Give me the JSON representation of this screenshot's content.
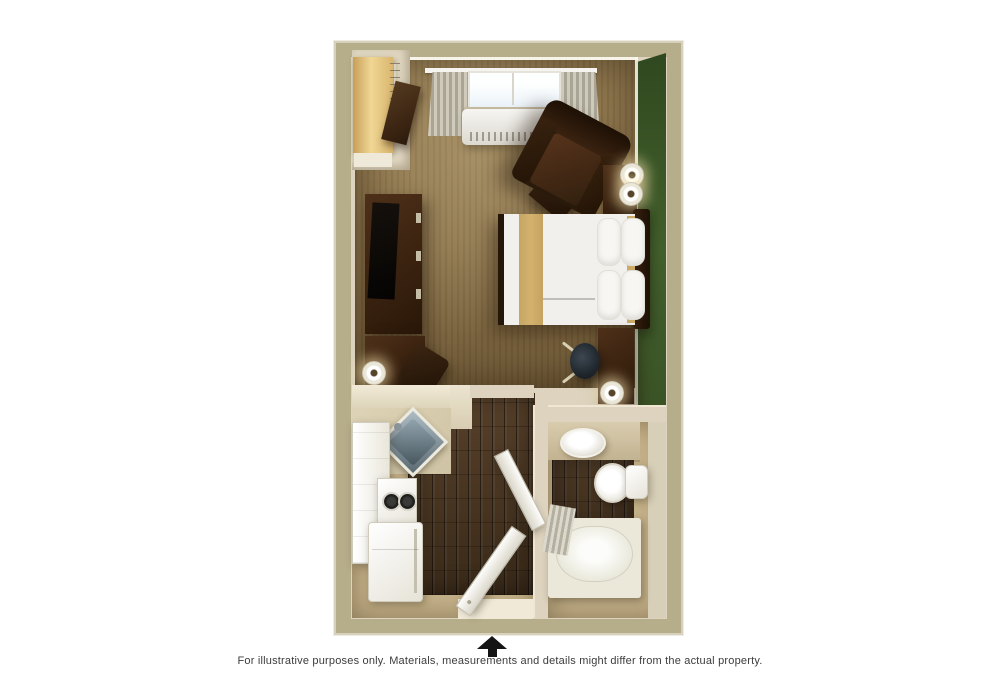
{
  "figure": {
    "type": "floor-plan",
    "description_visible_text_only": true
  },
  "caption": {
    "text": "For illustrative purposes only.  Materials, measurements and details might differ from the actual property."
  },
  "entrance": {
    "marker": "up-arrow"
  },
  "palette": {
    "outer_wall": "#b6ad8b",
    "wall_face": "#ddd3be",
    "carpet": "#8b734b",
    "wood_floor": "#4e3a26",
    "bath_floor": "#c4b189",
    "green_wall": "#42602c",
    "furniture_dark": "#2a1708",
    "bed_white": "#f1f0ed",
    "bed_accent_tan": "#d4b26e",
    "closet_wood": "#e9cf92",
    "appliance_white": "#f7f6f1",
    "curtain_gray": "#b5b1a2",
    "window_glass": "#e9f2f8",
    "arrow": "#141414",
    "text": "#3c3c3c"
  }
}
